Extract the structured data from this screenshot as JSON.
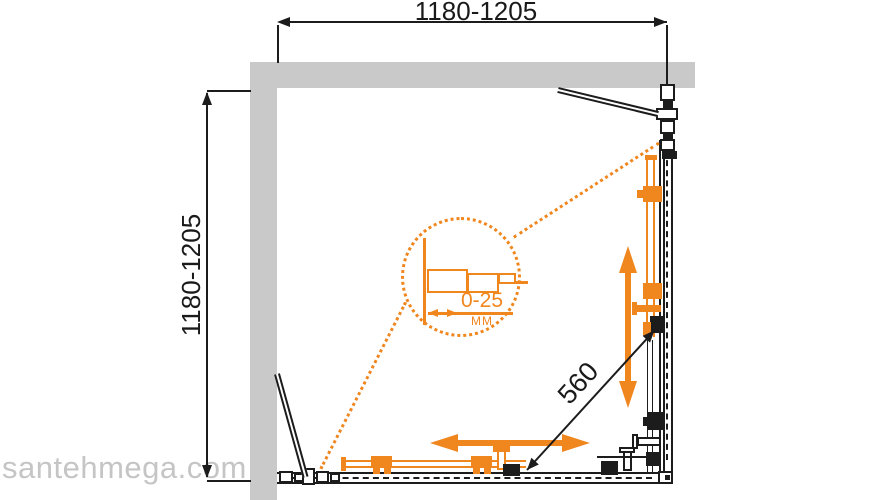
{
  "drawing": {
    "dimensions": {
      "width_range": "1180-1205",
      "depth_range": "1180-1205",
      "door_opening": "560"
    },
    "detail": {
      "range_label": "0-25",
      "unit_label": "MM"
    },
    "watermark": "santehmega.com",
    "colors": {
      "accent_orange": "#f0861e",
      "wall_gray": "#c9c9c9",
      "line_black": "#1c1c1c",
      "watermark_gray": "#c5c5c5"
    }
  }
}
